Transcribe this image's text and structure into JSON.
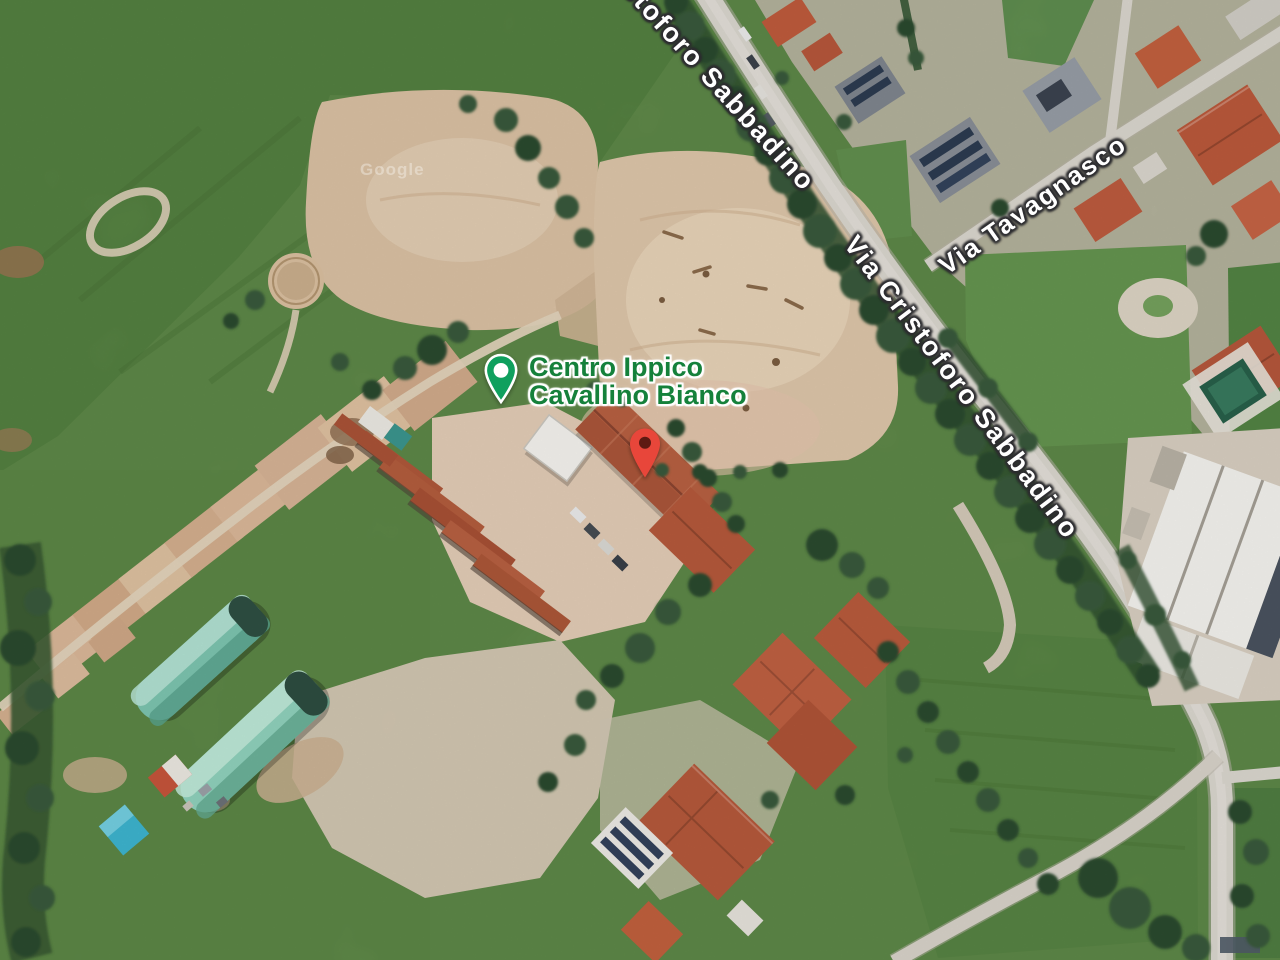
{
  "map": {
    "view": "satellite",
    "watermark": "Google",
    "poi": {
      "name_line1": "Centro Ippico",
      "name_line2": "Cavallino Bianco",
      "label_color": "#15813B",
      "pin_color": "#0FA05E"
    },
    "destination_marker": {
      "color": "#E8463A"
    },
    "street_labels": [
      {
        "name": "Cristoforo Sabbadino"
      },
      {
        "name": "Via Cristoforo Sabbadino"
      },
      {
        "name": "Via Tavagnasco"
      }
    ],
    "terrain_colors": {
      "field_green": "#66904E",
      "sand": "#DCC4A8",
      "road": "#D9D5CD",
      "roof_red": "#B75A3C",
      "greenhouse_teal": "#8FD0BB",
      "warehouse_white": "#F2F1ED"
    }
  }
}
